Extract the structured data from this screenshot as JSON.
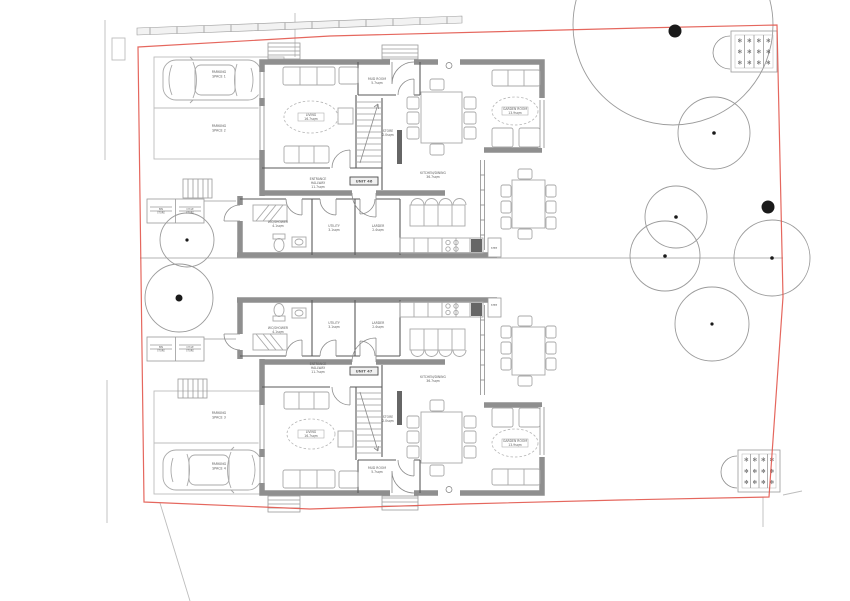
{
  "colors": {
    "boundary": "#e2574c",
    "walls": "#8f8f8f",
    "blueprint_line": "#9a9a9a",
    "label_text": "#5f5f5f",
    "tree_dot": "#1a1a1a"
  },
  "units": [
    {
      "name": "UNIT 46"
    },
    {
      "name": "UNIT 47"
    }
  ],
  "site": {
    "plant_glyph": "✻",
    "planters": [
      {
        "x": 731,
        "y": 31,
        "w": 46,
        "h": 41,
        "cols": 4,
        "rows": 3
      },
      {
        "x": 738,
        "y": 450,
        "w": 42,
        "h": 42,
        "cols": 4,
        "rows": 3
      }
    ],
    "trees": [
      {
        "cx": 673,
        "cy": 25,
        "r": 100,
        "dot": 0
      },
      {
        "cx": 714,
        "cy": 133,
        "r": 36,
        "dot": 1.8
      },
      {
        "cx": 676,
        "cy": 217,
        "r": 31,
        "dot": 1.8
      },
      {
        "cx": 665,
        "cy": 256,
        "r": 35,
        "dot": 1.8
      },
      {
        "cx": 772,
        "cy": 258,
        "r": 38,
        "dot": 1.8
      },
      {
        "cx": 712,
        "cy": 324,
        "r": 37,
        "dot": 1.6
      },
      {
        "cx": 187,
        "cy": 240,
        "r": 27,
        "dot": 1.6
      },
      {
        "cx": 179,
        "cy": 298,
        "r": 34,
        "dot": 3.5
      }
    ],
    "proposed_tree_dots": [
      {
        "x": 675,
        "y": 31,
        "r": 6.5
      },
      {
        "x": 768,
        "y": 207,
        "r": 6.5
      }
    ]
  },
  "labels": [
    {
      "kind": "parking",
      "lines": [
        "PARKING",
        "SPACE 1"
      ],
      "x": 219,
      "y": 74
    },
    {
      "kind": "parking",
      "lines": [
        "PARKING",
        "SPACE 2"
      ],
      "x": 219,
      "y": 128
    },
    {
      "kind": "parking",
      "lines": [
        "PARKING",
        "SPACE 3"
      ],
      "x": 219,
      "y": 415
    },
    {
      "kind": "parking",
      "lines": [
        "PARKING",
        "SPACE 4"
      ],
      "x": 219,
      "y": 466
    },
    {
      "kind": "room",
      "lines": [
        "LIVING",
        "16.7sqm"
      ],
      "x": 311,
      "y": 117,
      "oval": {
        "rx": 27,
        "ry": 16
      },
      "plate": true
    },
    {
      "kind": "room",
      "lines": [
        "MUD ROOM",
        "5.7sqm"
      ],
      "x": 377,
      "y": 81
    },
    {
      "kind": "room",
      "lines": [
        "STORE",
        "2.0sqm"
      ],
      "x": 388,
      "y": 133
    },
    {
      "kind": "room",
      "lines": [
        "ENTRANCE",
        "HALLWAY",
        "11.7sqm"
      ],
      "x": 318,
      "y": 183
    },
    {
      "kind": "unit",
      "lines": [
        "UNIT 46"
      ],
      "x": 364,
      "y": 181
    },
    {
      "kind": "room",
      "lines": [
        "KITCHEN/DINING",
        "36.7sqm"
      ],
      "x": 433,
      "y": 175
    },
    {
      "kind": "room",
      "lines": [
        "GARDEN ROOM",
        "13.9sqm"
      ],
      "x": 515,
      "y": 111,
      "oval": {
        "rx": 23,
        "ry": 14
      },
      "plate": true
    },
    {
      "kind": "room",
      "lines": [
        "WC/SHOWER",
        "4.1sqm"
      ],
      "x": 278,
      "y": 224
    },
    {
      "kind": "room",
      "lines": [
        "UTILITY",
        "3.1sqm"
      ],
      "x": 334,
      "y": 228
    },
    {
      "kind": "room",
      "lines": [
        "LARDER",
        "2.4sqm"
      ],
      "x": 378,
      "y": 228
    },
    {
      "kind": "step",
      "lines": [
        "STEP"
      ],
      "x": 494,
      "y": 248
    },
    {
      "kind": "room",
      "lines": [
        "WC/SHOWER",
        "4.1sqm"
      ],
      "x": 278,
      "y": 330
    },
    {
      "kind": "room",
      "lines": [
        "UTILITY",
        "3.1sqm"
      ],
      "x": 334,
      "y": 325
    },
    {
      "kind": "room",
      "lines": [
        "LARDER",
        "2.4sqm"
      ],
      "x": 378,
      "y": 325
    },
    {
      "kind": "step",
      "lines": [
        "STEP"
      ],
      "x": 494,
      "y": 305
    },
    {
      "kind": "room",
      "lines": [
        "KITCHEN/DINING",
        "36.7sqm"
      ],
      "x": 433,
      "y": 379
    },
    {
      "kind": "unit",
      "lines": [
        "UNIT 47"
      ],
      "x": 364,
      "y": 371
    },
    {
      "kind": "room",
      "lines": [
        "ENTRANCE",
        "HALLWAY",
        "11.7sqm"
      ],
      "x": 318,
      "y": 368
    },
    {
      "kind": "room",
      "lines": [
        "STORE",
        "2.0sqm"
      ],
      "x": 388,
      "y": 419
    },
    {
      "kind": "room",
      "lines": [
        "LIVING",
        "16.7sqm"
      ],
      "x": 311,
      "y": 434,
      "oval": {
        "rx": 24,
        "ry": 15
      },
      "plate": true
    },
    {
      "kind": "room",
      "lines": [
        "GARDEN ROOM",
        "13.9sqm"
      ],
      "x": 515,
      "y": 443,
      "oval": {
        "rx": 23,
        "ry": 14
      },
      "plate": true
    },
    {
      "kind": "room",
      "lines": [
        "MUD ROOM",
        "5.7sqm"
      ],
      "x": 377,
      "y": 470
    },
    {
      "kind": "store",
      "lines": [
        "BIN",
        "STORE"
      ],
      "x": 161,
      "y": 211
    },
    {
      "kind": "store",
      "lines": [
        "CYCLE",
        "STORE"
      ],
      "x": 190,
      "y": 211
    },
    {
      "kind": "store",
      "lines": [
        "BIN",
        "STORE"
      ],
      "x": 161,
      "y": 349
    },
    {
      "kind": "store",
      "lines": [
        "CYCLE",
        "STORE"
      ],
      "x": 190,
      "y": 349
    }
  ]
}
